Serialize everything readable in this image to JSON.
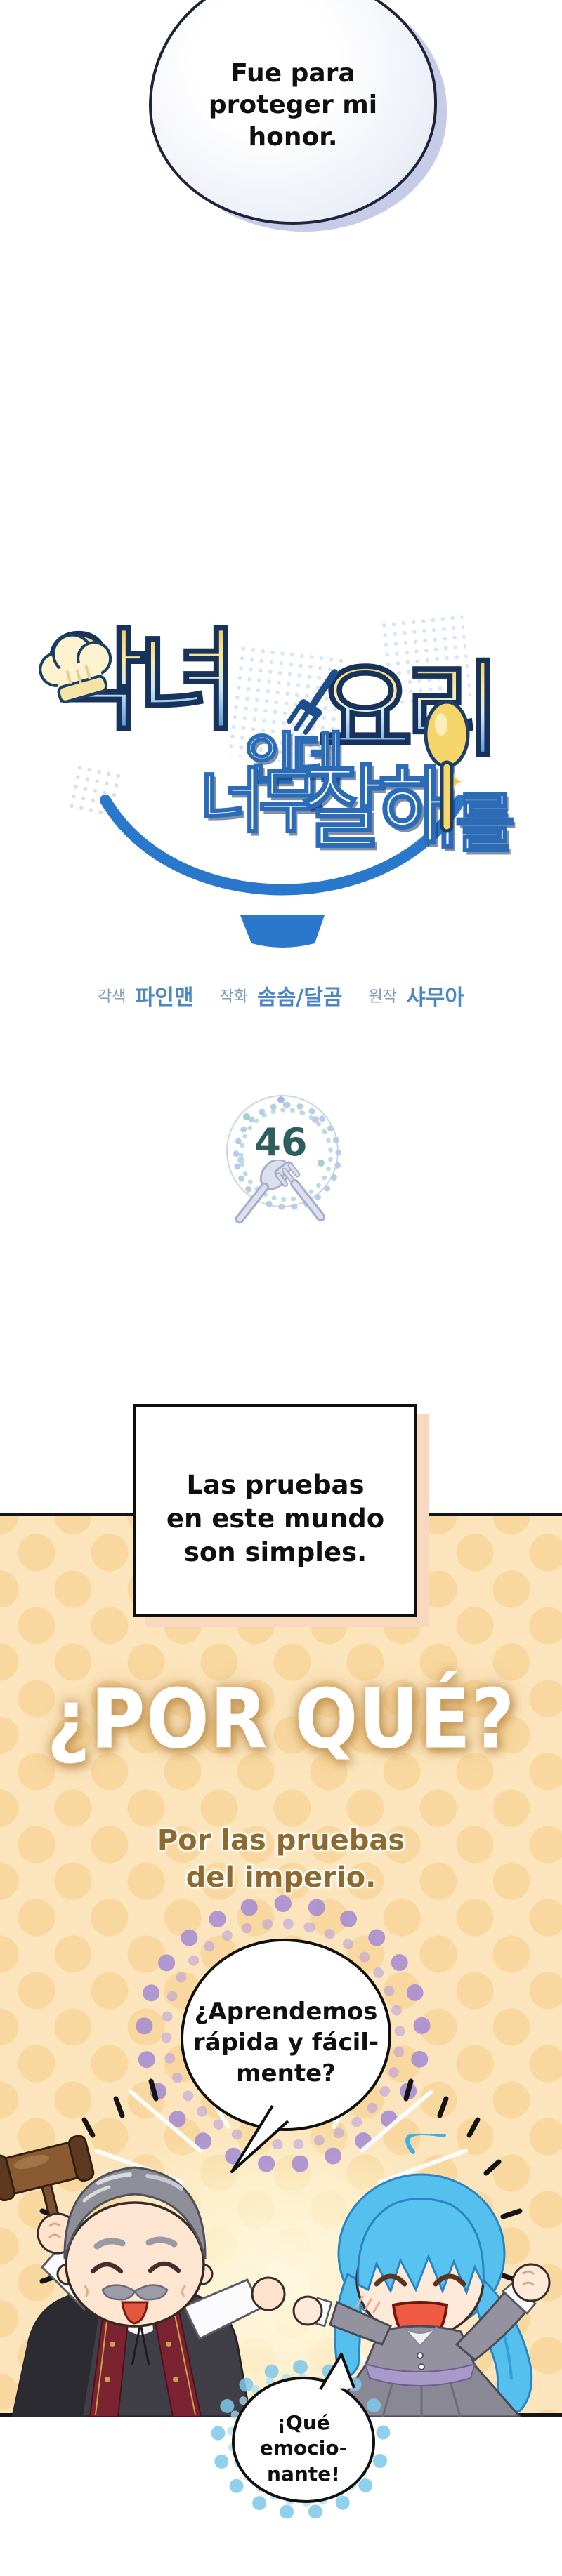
{
  "comic": {
    "top_bubble": {
      "lines": [
        "Fue para",
        "proteger mi",
        "honor."
      ]
    },
    "title": {
      "word_1": "악녀",
      "word_2": "인데",
      "word_3": "요리",
      "word_4": "를",
      "word_5": "너무",
      "word_6": "잘해"
    },
    "credits": [
      {
        "role": "각색",
        "name": "파인맨"
      },
      {
        "role": "작화",
        "name": "솜솜/달곰"
      },
      {
        "role": "원작",
        "name": "샤무아"
      }
    ],
    "episode": {
      "number": "46"
    },
    "narration_box": {
      "lines": [
        "Las pruebas",
        "en este mundo",
        "son simples."
      ]
    },
    "shout_text": "¿POR QUÉ?",
    "caption": {
      "lines": [
        "Por las pruebas",
        "del imperio."
      ]
    },
    "question_bubble": {
      "lines": [
        "¿Aprendemos",
        "rápida y fácil-",
        "mente?"
      ]
    },
    "excited_bubble": {
      "lines": [
        "¡Qué emocio-",
        "nante!"
      ]
    },
    "icons": {
      "sparkle": "✦"
    },
    "colors": {
      "title_blue": "#2e7cc8",
      "title_yellow": "#f5cf5a",
      "panel_bg": "#fce5bc",
      "panel_dot": "#f8d89f",
      "purple_halo": "#9e84d8",
      "blue_halo": "#7ec8ea",
      "caption_brown": "#8d6b2e",
      "box_shadow_peach": "#f8d9c0",
      "bubble_shadow_lavender": "#c6cce8",
      "credit_name_blue": "#4c86c5",
      "episode_teal": "#2e5f5e"
    }
  }
}
